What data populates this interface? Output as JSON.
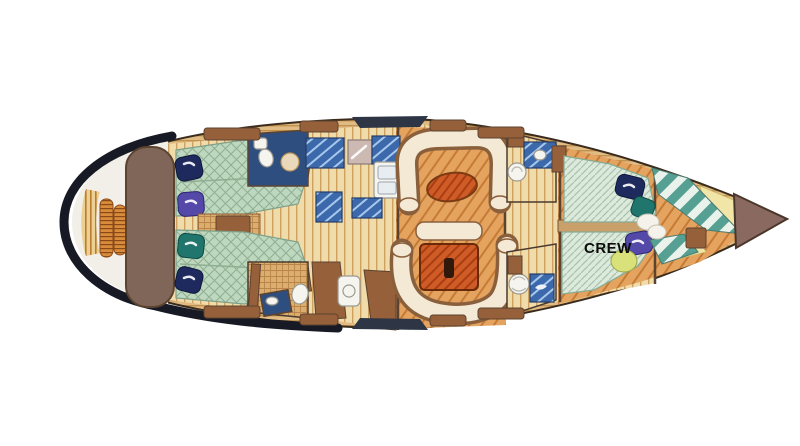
{
  "figure": {
    "kind": "sailing-yacht-interior-layout-plan",
    "alt": "Top-down interior layout plan of a sailing yacht, bow pointing right, stern with swim platform at left"
  },
  "labels": {
    "crew_cabin": "CREW"
  },
  "regions": [
    {
      "name": "swim-platform"
    },
    {
      "name": "transom-seat"
    },
    {
      "name": "aft-cabin-top"
    },
    {
      "name": "aft-cabin-bottom"
    },
    {
      "name": "aft-head-top"
    },
    {
      "name": "aft-head-bottom"
    },
    {
      "name": "galley"
    },
    {
      "name": "salon"
    },
    {
      "name": "forward-head-top"
    },
    {
      "name": "forward-head-bottom"
    },
    {
      "name": "crew-cabin"
    },
    {
      "name": "sail-locker"
    },
    {
      "name": "anchor-locker"
    }
  ],
  "colors": {
    "background": "#ffffff",
    "hull_outline": "#3a2b1c",
    "stern_navy": "#171a24",
    "stern_white": "#f2efe8",
    "deck_wood": "#e0bb83",
    "deck_wood_line": "#c2914d",
    "platform_wood": "#ecd093",
    "platform_line": "#b97c31",
    "coil_orange": "#d98b3c",
    "coil_line": "#8a4a18",
    "transom_brown": "#806659",
    "floor_cream": "#f0dcab",
    "floor_line": "#cfa161",
    "floor_orange": "#e4a35f",
    "floor_orange_line": "#c57b35",
    "mattress_green": "#bdd8be",
    "mattress_line": "#8fae92",
    "crew_mattress": "#dce9db",
    "crew_mattress_line": "#a6c3af",
    "pillow_navy": "#1e2a5e",
    "pillow_purple": "#5448a8",
    "pillow_teal": "#20766d",
    "pillow_lime": "#d9e27a",
    "settee_cream": "#f3e9d4",
    "settee_outline": "#8a5f3c",
    "table_orange": "#cf5b26",
    "table_line": "#a93e12",
    "counter_blue": "#3c69ab",
    "counter_streak": "#a8c8ec",
    "bath_navy": "#2e4e80",
    "grate_wood": "#dcae6e",
    "grate_line": "#b9854a",
    "wood_brown": "#96603a",
    "dark_brown": "#5c4330",
    "bow_teal": "#55a092",
    "bow_white": "#eaf2ec",
    "bow_yellow": "#f1e6a8",
    "bow_tip": "#8a6a60",
    "label_black": "#0c0c0c"
  }
}
